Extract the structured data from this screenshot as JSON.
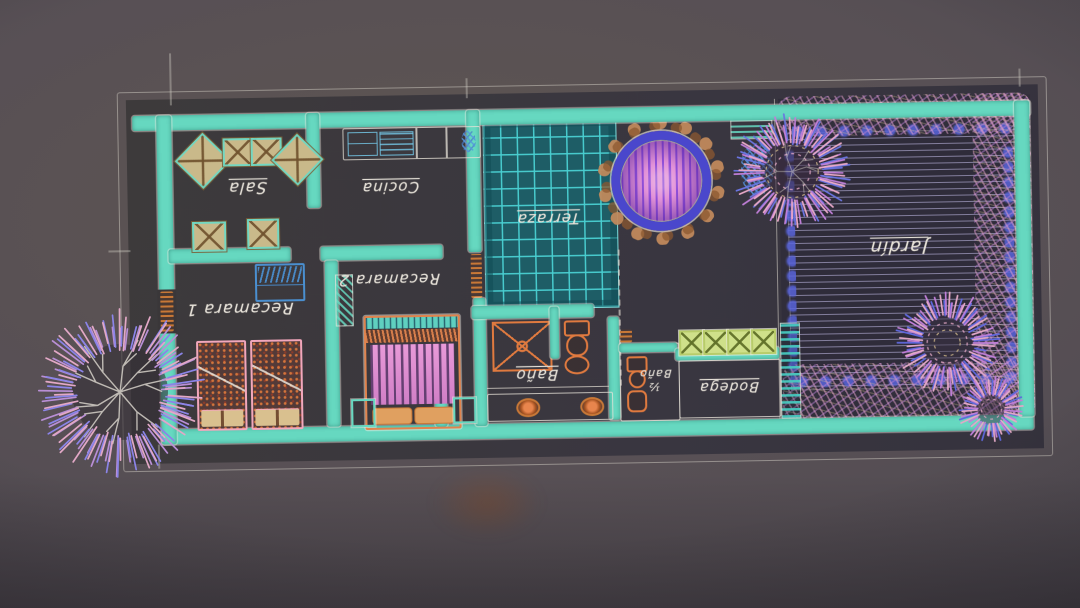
{
  "scene": {
    "description": "Hand-drawn architectural floor plan sketched in colored chalk on a dark board, photographed upside-down",
    "orientation": "labels rotated 180°"
  },
  "palette": {
    "background": "#57504f",
    "plan_floor": "#3a3739",
    "wall_teal": "#66d8c0",
    "sketch_white": "#ddd7cd",
    "furniture_tan": "#c9b98a",
    "detail_blue": "#4a8fd0",
    "terrace_teal": "#1e5d66",
    "terrace_grid": "#49cfd2",
    "pool_ring_blue": "#4a47cc",
    "pool_pink": "#e292d8",
    "stone_tan": "#c08a5c",
    "lawn_line": "#bbb4df",
    "garden_blue": "#5863da",
    "veg_pink": "#e2a0ca",
    "veg_purple": "#b87fd2",
    "bed_pink": "#f2a7bc",
    "fixture_orange": "#e07a3f",
    "shelf_green": "#cfe08a",
    "label_white": "#e6e1d8"
  },
  "rooms": {
    "sala": {
      "label": "Sala"
    },
    "cocina": {
      "label": "Cocina"
    },
    "terraza": {
      "label": "Terraza"
    },
    "jardin": {
      "label": "Jardín"
    },
    "recamara1": {
      "label": "Recamara 1"
    },
    "recamara2": {
      "label": "Recamara 2"
    },
    "bano": {
      "label": "Baño"
    },
    "medio_bano": {
      "label": "Baño",
      "fraction": "½"
    },
    "bodega": {
      "label": "Bodega"
    }
  }
}
